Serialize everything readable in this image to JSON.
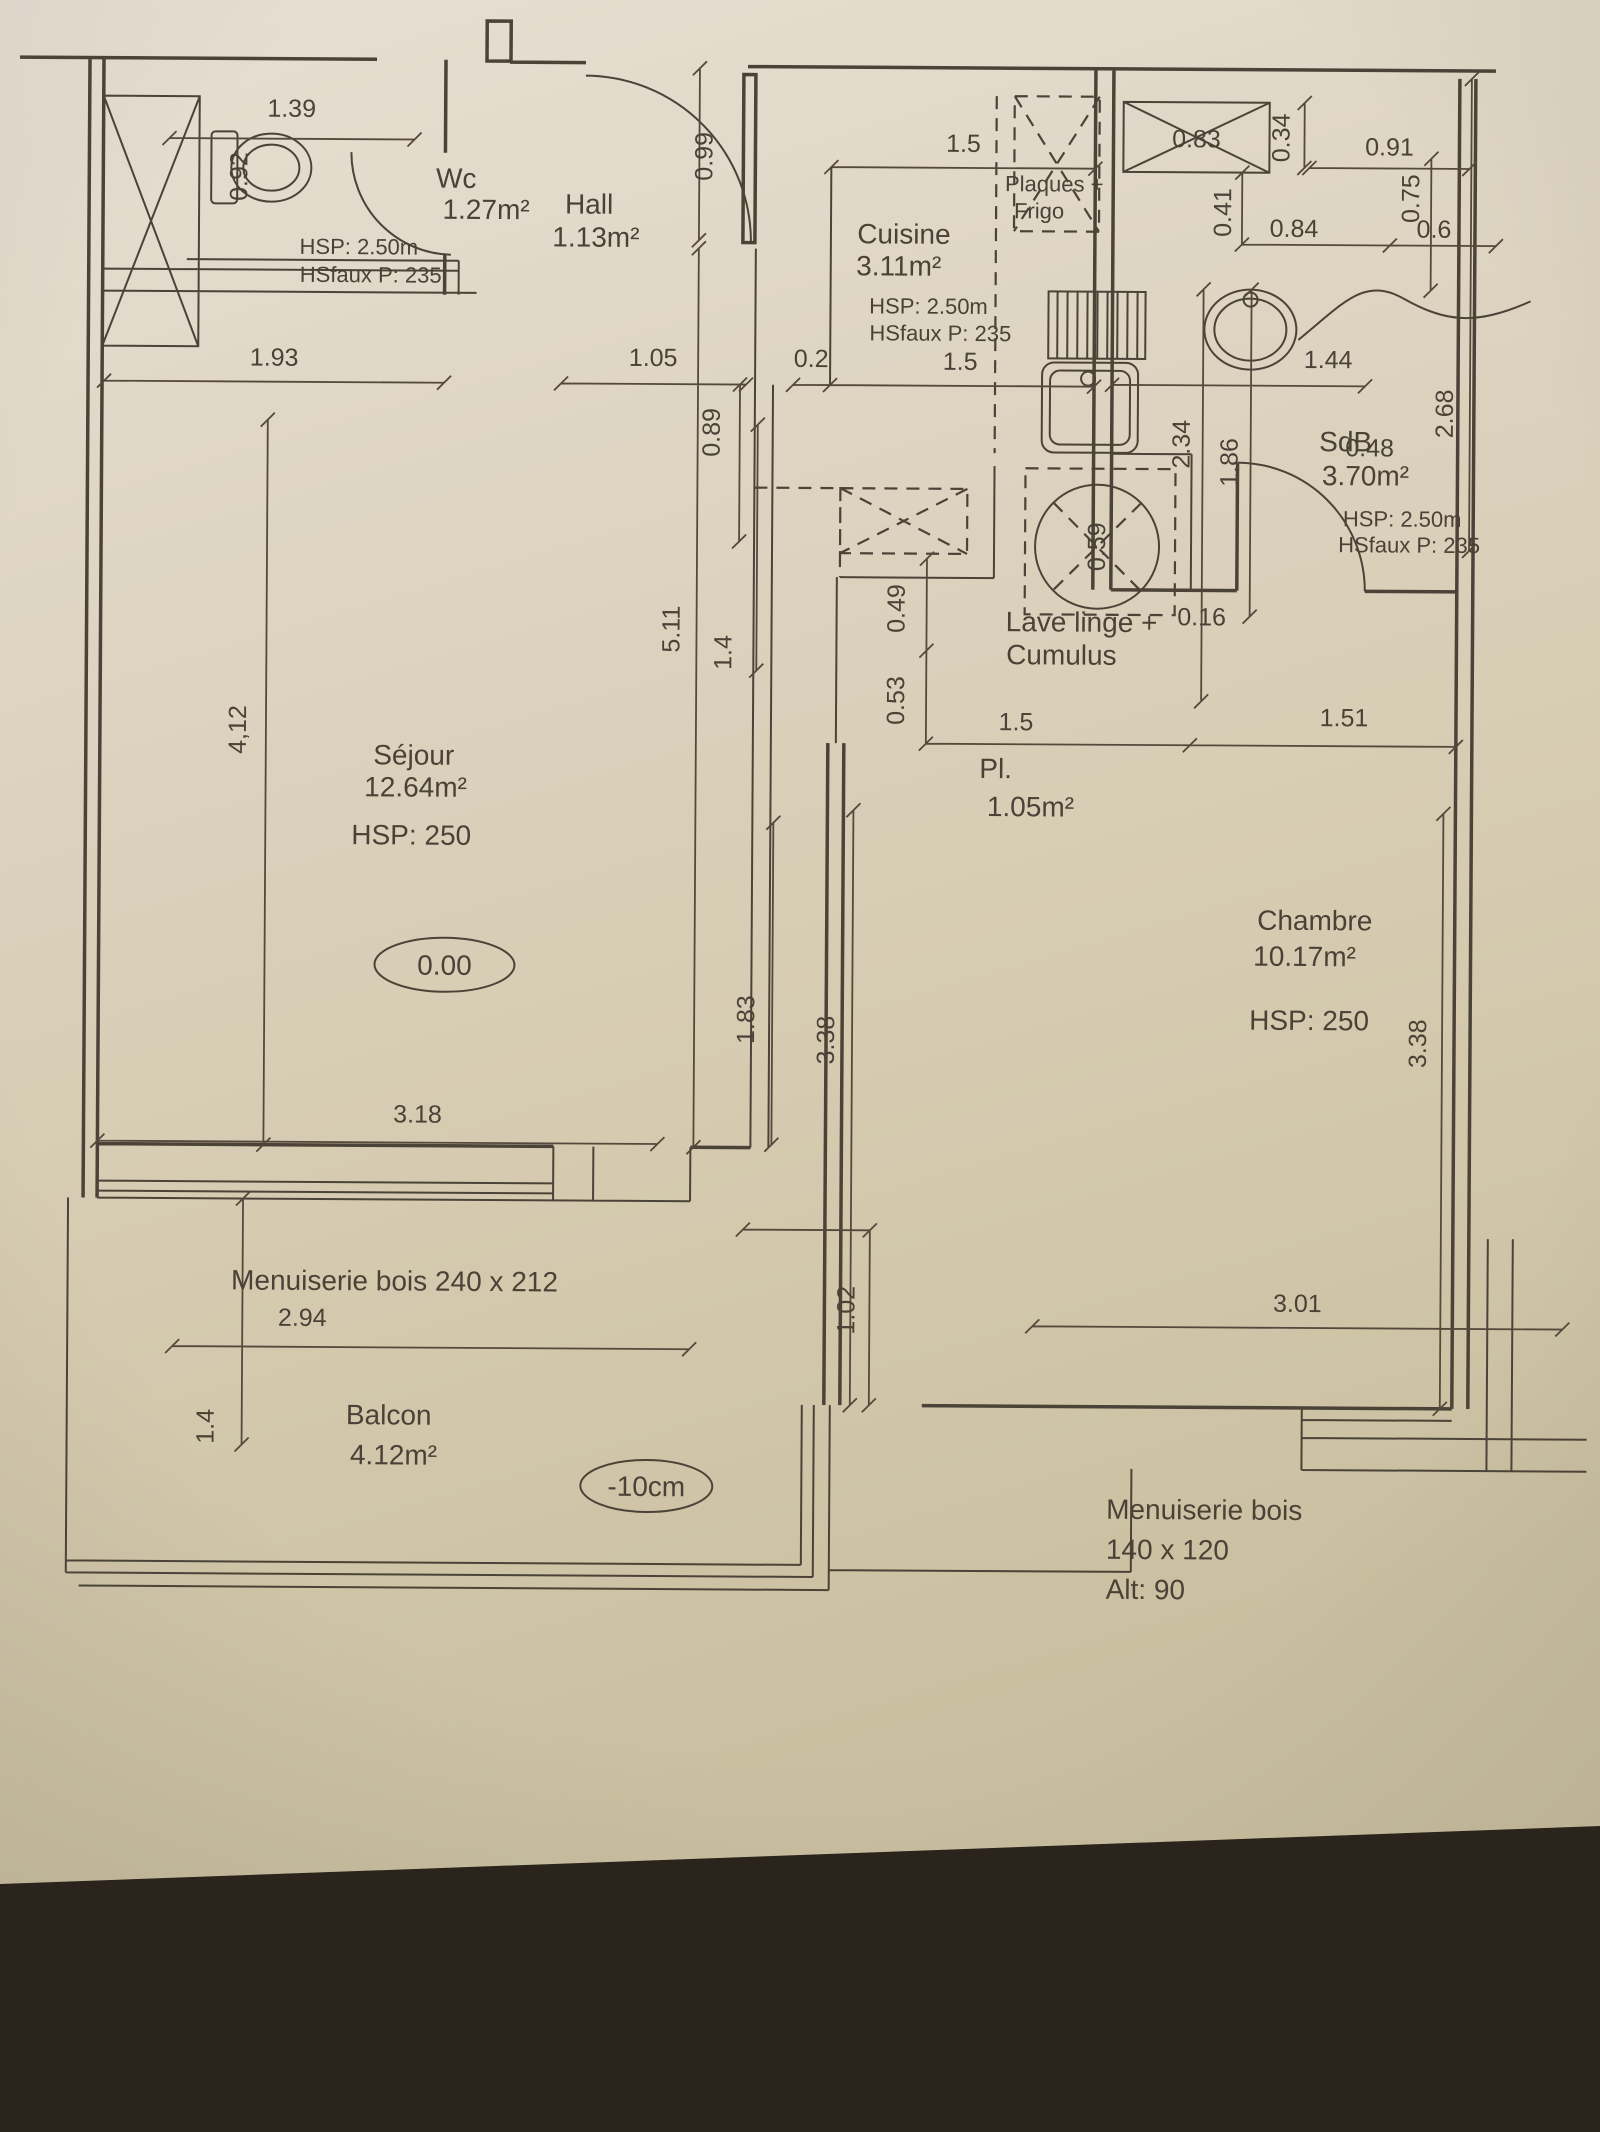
{
  "plan": {
    "rooms": {
      "wc": {
        "name": "Wc",
        "area": "1.27m²",
        "hsp": "HSP: 2.50m",
        "hsfaux": "HSfaux P: 235"
      },
      "hall": {
        "name": "Hall",
        "area": "1.13m²"
      },
      "cuisine": {
        "name": "Cuisine",
        "area": "3.11m²",
        "hsp": "HSP: 2.50m",
        "hsfaux": "HSfaux P: 235"
      },
      "sdb": {
        "name": "SdB",
        "area": "3.70m²",
        "hsp": "HSP: 2.50m",
        "hsfaux": "HSfaux P: 235"
      },
      "sejour": {
        "name": "Séjour",
        "area": "12.64m²",
        "hsp": "HSP: 250",
        "floor_level": "0.00"
      },
      "placard": {
        "name": "Pl.",
        "area": "1.05m²"
      },
      "chambre": {
        "name": "Chambre",
        "area": "10.17m²",
        "hsp": "HSP: 250"
      },
      "balcon": {
        "name": "Balcon",
        "area": "4.12m²",
        "floor_level": "-10cm"
      }
    },
    "equipment": {
      "plaques": "Plaques +",
      "frigo": "Frigo",
      "lave_linge": "Lave linge +",
      "cumulus": "Cumulus"
    },
    "joinery": {
      "sejour_window": "Menuiserie bois 240 x 212",
      "chambre_window_line1": "Menuiserie bois",
      "chambre_window_line2": "140 x 120",
      "chambre_window_line3": "Alt: 90"
    },
    "dimensions": {
      "wc_width": "1.39",
      "hall_entry": "0.99",
      "kitchen_top": "1.5",
      "shaft_top": "0.83",
      "d034": "0.34",
      "d091": "0.91",
      "d075": "0.75",
      "d041": "0.41",
      "d084": "0.84",
      "d06": "0.6",
      "sejour_top": "1.93",
      "hall_width": "1.05",
      "d02": "0.2",
      "kitchen_bottom": "1.5",
      "sdb_width": "1.44",
      "sdb_height": "2.68",
      "d234": "2.34",
      "d186": "1.86",
      "d089": "0.89",
      "depth_total": "5.11",
      "d14": "1.4",
      "d049": "0.49",
      "cumulus_d": "0.59",
      "d053": "0.53",
      "sdb_door": "0.48",
      "d016": "0.16",
      "pl_width": "1.5",
      "chambre_top": "1.51",
      "sejour_height": "4,12",
      "d183": "1.83",
      "chambre_h_left": "3.38",
      "chambre_h_right": "3.38",
      "d102": "1.02",
      "sejour_width": "3.18",
      "balcon_window": "2.94",
      "chambre_width": "3.01",
      "balcon_depth": "1.4",
      "toilet_d": "0.92"
    }
  }
}
